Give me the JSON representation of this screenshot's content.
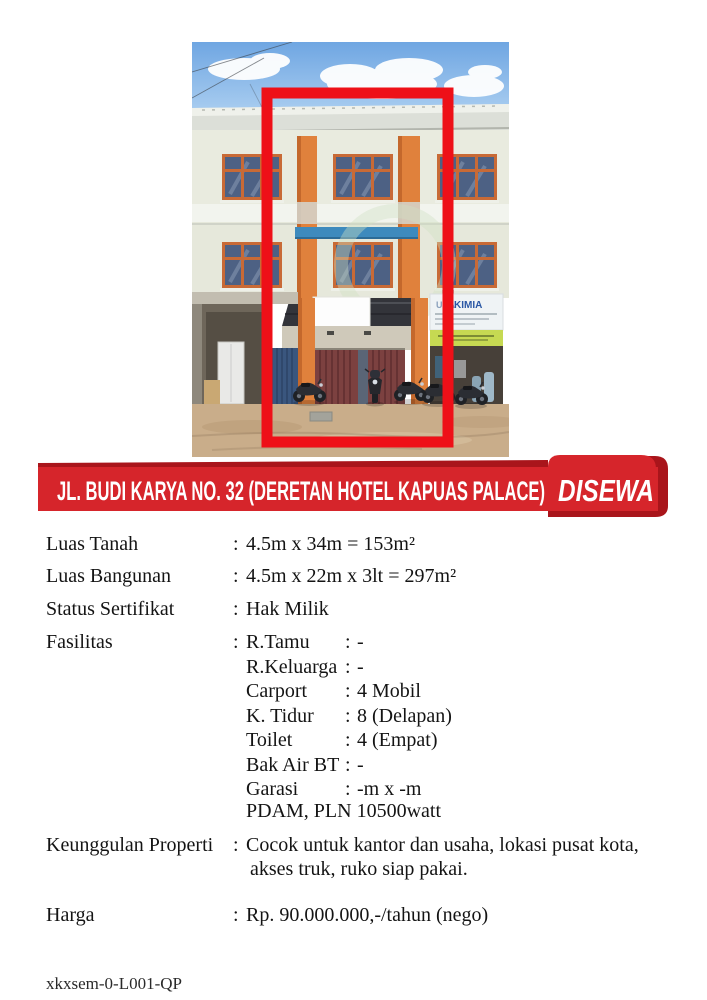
{
  "colon": ":",
  "banner": {
    "address": "JL. BUDI KARYA NO. 32 (DERETAN HOTEL KAPUAS PALACE)",
    "status": "DISEWA",
    "red": "#d6252b",
    "dark_red": "#a9151b",
    "text_color": "#ffffff"
  },
  "photo": {
    "shop_sign_prefix": "USA",
    "shop_sign": "KIMIA",
    "highlight_color": "#ee1018"
  },
  "details": {
    "rows": [
      {
        "label": "Luas Tanah",
        "value": "4.5m x 34m = 153m²"
      },
      {
        "label": "Luas Bangunan",
        "value": "4.5m x 22m x 3lt = 297m²"
      },
      {
        "label": "Status Sertifikat",
        "value": "Hak Milik"
      }
    ],
    "fasilitas_label": "Fasilitas",
    "fasilitas": [
      {
        "name": "R.Tamu",
        "value": "-"
      },
      {
        "name": "R.Keluarga",
        "value": "-"
      },
      {
        "name": "Carport",
        "value": "4 Mobil"
      },
      {
        "name": "K. Tidur",
        "value": "8 (Delapan)"
      },
      {
        "name": "Toilet",
        "value": "4 (Empat)"
      },
      {
        "name": "Bak Air BT",
        "value": "-"
      },
      {
        "name": "Garasi",
        "value": "-m x -m"
      },
      {
        "name": "PDAM, PLN 10500watt",
        "value": ""
      }
    ],
    "keunggulan": {
      "label": "Keunggulan Properti",
      "lines": [
        "Cocok untuk kantor dan usaha, lokasi pusat kota,",
        "akses truk, ruko siap pakai."
      ]
    },
    "harga": {
      "label": "Harga",
      "value": "Rp. 90.000.000,-/tahun (nego)"
    }
  },
  "footer": {
    "code": "xkxsem-0-L001-QP"
  }
}
